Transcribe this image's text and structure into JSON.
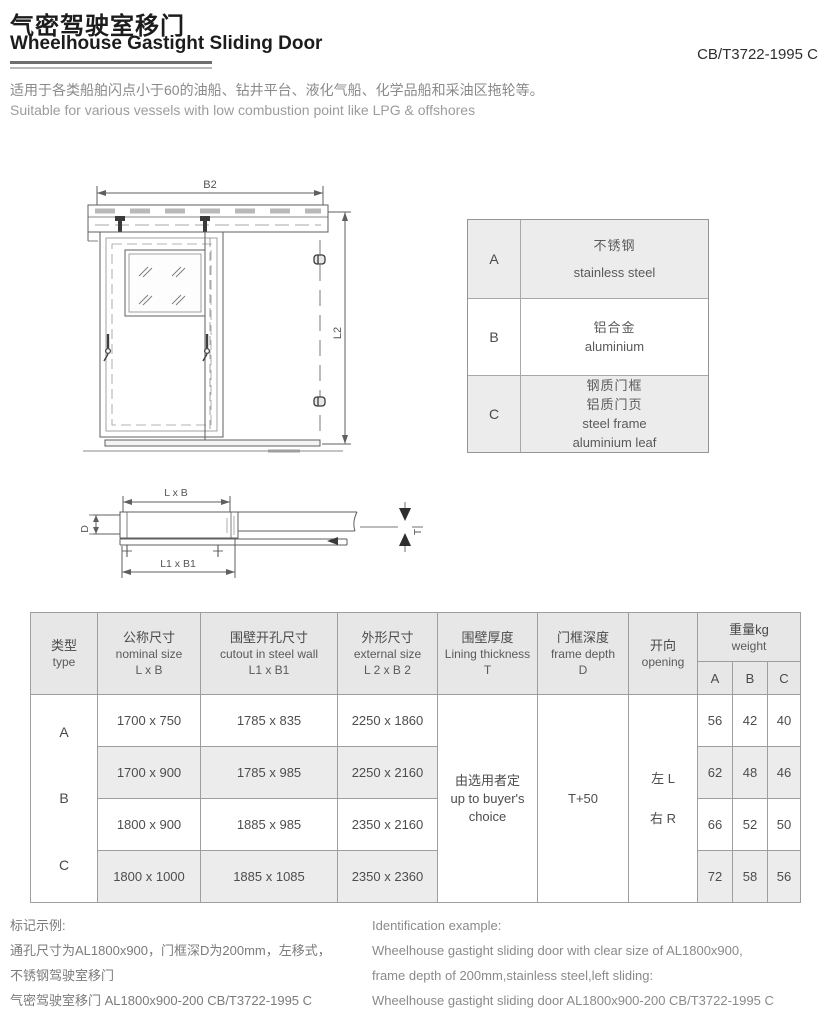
{
  "page": {
    "title_zh": "气密驾驶室移门",
    "title_en": "Wheelhouse Gastight Sliding Door",
    "standard_code": "CB/T3722-1995 C",
    "description_zh": "适用于各类船舶闪点小于60的油船、钻井平台、液化气船、化学品船和采油区拖轮等。",
    "description_en": "Suitable for various vessels with low combustion point like LPG & offshores"
  },
  "drawing_labels": {
    "front_width": "B2",
    "front_height": "L2",
    "plan_clear_size": "L x B",
    "plan_cutout_size": "L1 x B1",
    "plan_frame_depth": "D",
    "plan_wall_thickness": "T"
  },
  "material_table": {
    "rows": [
      {
        "type": "A",
        "zh1": "不锈钢",
        "en1": "stainless steel"
      },
      {
        "type": "B",
        "zh1": "铝合金",
        "en1": "aluminium"
      },
      {
        "type": "C",
        "zh1": "钢质门框",
        "zh2": "铝质门页",
        "en1": "steel frame",
        "en2": "aluminium leaf"
      }
    ]
  },
  "spec_table": {
    "headers": {
      "type": [
        "类型",
        "type"
      ],
      "nominal": [
        "公称尺寸",
        "nominal size",
        "L x B"
      ],
      "cutout": [
        "围壁开孔尺寸",
        "cutout in steel wall",
        "L1 x B1"
      ],
      "external": [
        "外形尺寸",
        "external size",
        "L 2  x B 2"
      ],
      "lining": [
        "围壁厚度",
        "Lining thickness",
        "T"
      ],
      "depth": [
        "门框深度",
        "frame depth",
        "D"
      ],
      "opening": [
        "开向",
        "opening"
      ],
      "weight": [
        "重量kg",
        "weight"
      ],
      "weight_cols": [
        "A",
        "B",
        "C"
      ]
    },
    "type_letters": [
      "A",
      "B",
      "C"
    ],
    "rows": [
      {
        "nominal": "1700 x 750",
        "cutout": "1785 x 835",
        "external": "2250 x 1860",
        "wa": "56",
        "wb": "42",
        "wc": "40"
      },
      {
        "nominal": "1700 x 900",
        "cutout": "1785 x 985",
        "external": "2250 x 2160",
        "wa": "62",
        "wb": "48",
        "wc": "46"
      },
      {
        "nominal": "1800 x 900",
        "cutout": "1885 x 985",
        "external": "2350 x 2160",
        "wa": "66",
        "wb": "52",
        "wc": "50"
      },
      {
        "nominal": "1800 x 1000",
        "cutout": "1885 x 1085",
        "external": "2350 x 2360",
        "wa": "72",
        "wb": "58",
        "wc": "56"
      }
    ],
    "merged": {
      "lining": [
        "由选用者定",
        "up to buyer's",
        "choice"
      ],
      "depth": "T+50",
      "opening_left": "左 L",
      "opening_right": "右 R"
    }
  },
  "example": {
    "zh": [
      "标记示例:",
      "通孔尺寸为AL1800x900，门框深D为200mm，左移式，",
      "不锈钢驾驶室移门",
      "气密驾驶室移门 AL1800x900-200 CB/T3722-1995 C"
    ],
    "en": [
      "Identification example:",
      "Wheelhouse gastight sliding door with clear size of AL1800x900,",
      "frame depth of 200mm,stainless steel,left sliding:",
      "Wheelhouse gastight sliding door AL1800x900-200 CB/T3722-1995 C"
    ]
  },
  "colors": {
    "table_header_bg": "#e7e7e7",
    "row_stripe_bg": "#ececec",
    "drawing_line": "#5f5f5f"
  }
}
